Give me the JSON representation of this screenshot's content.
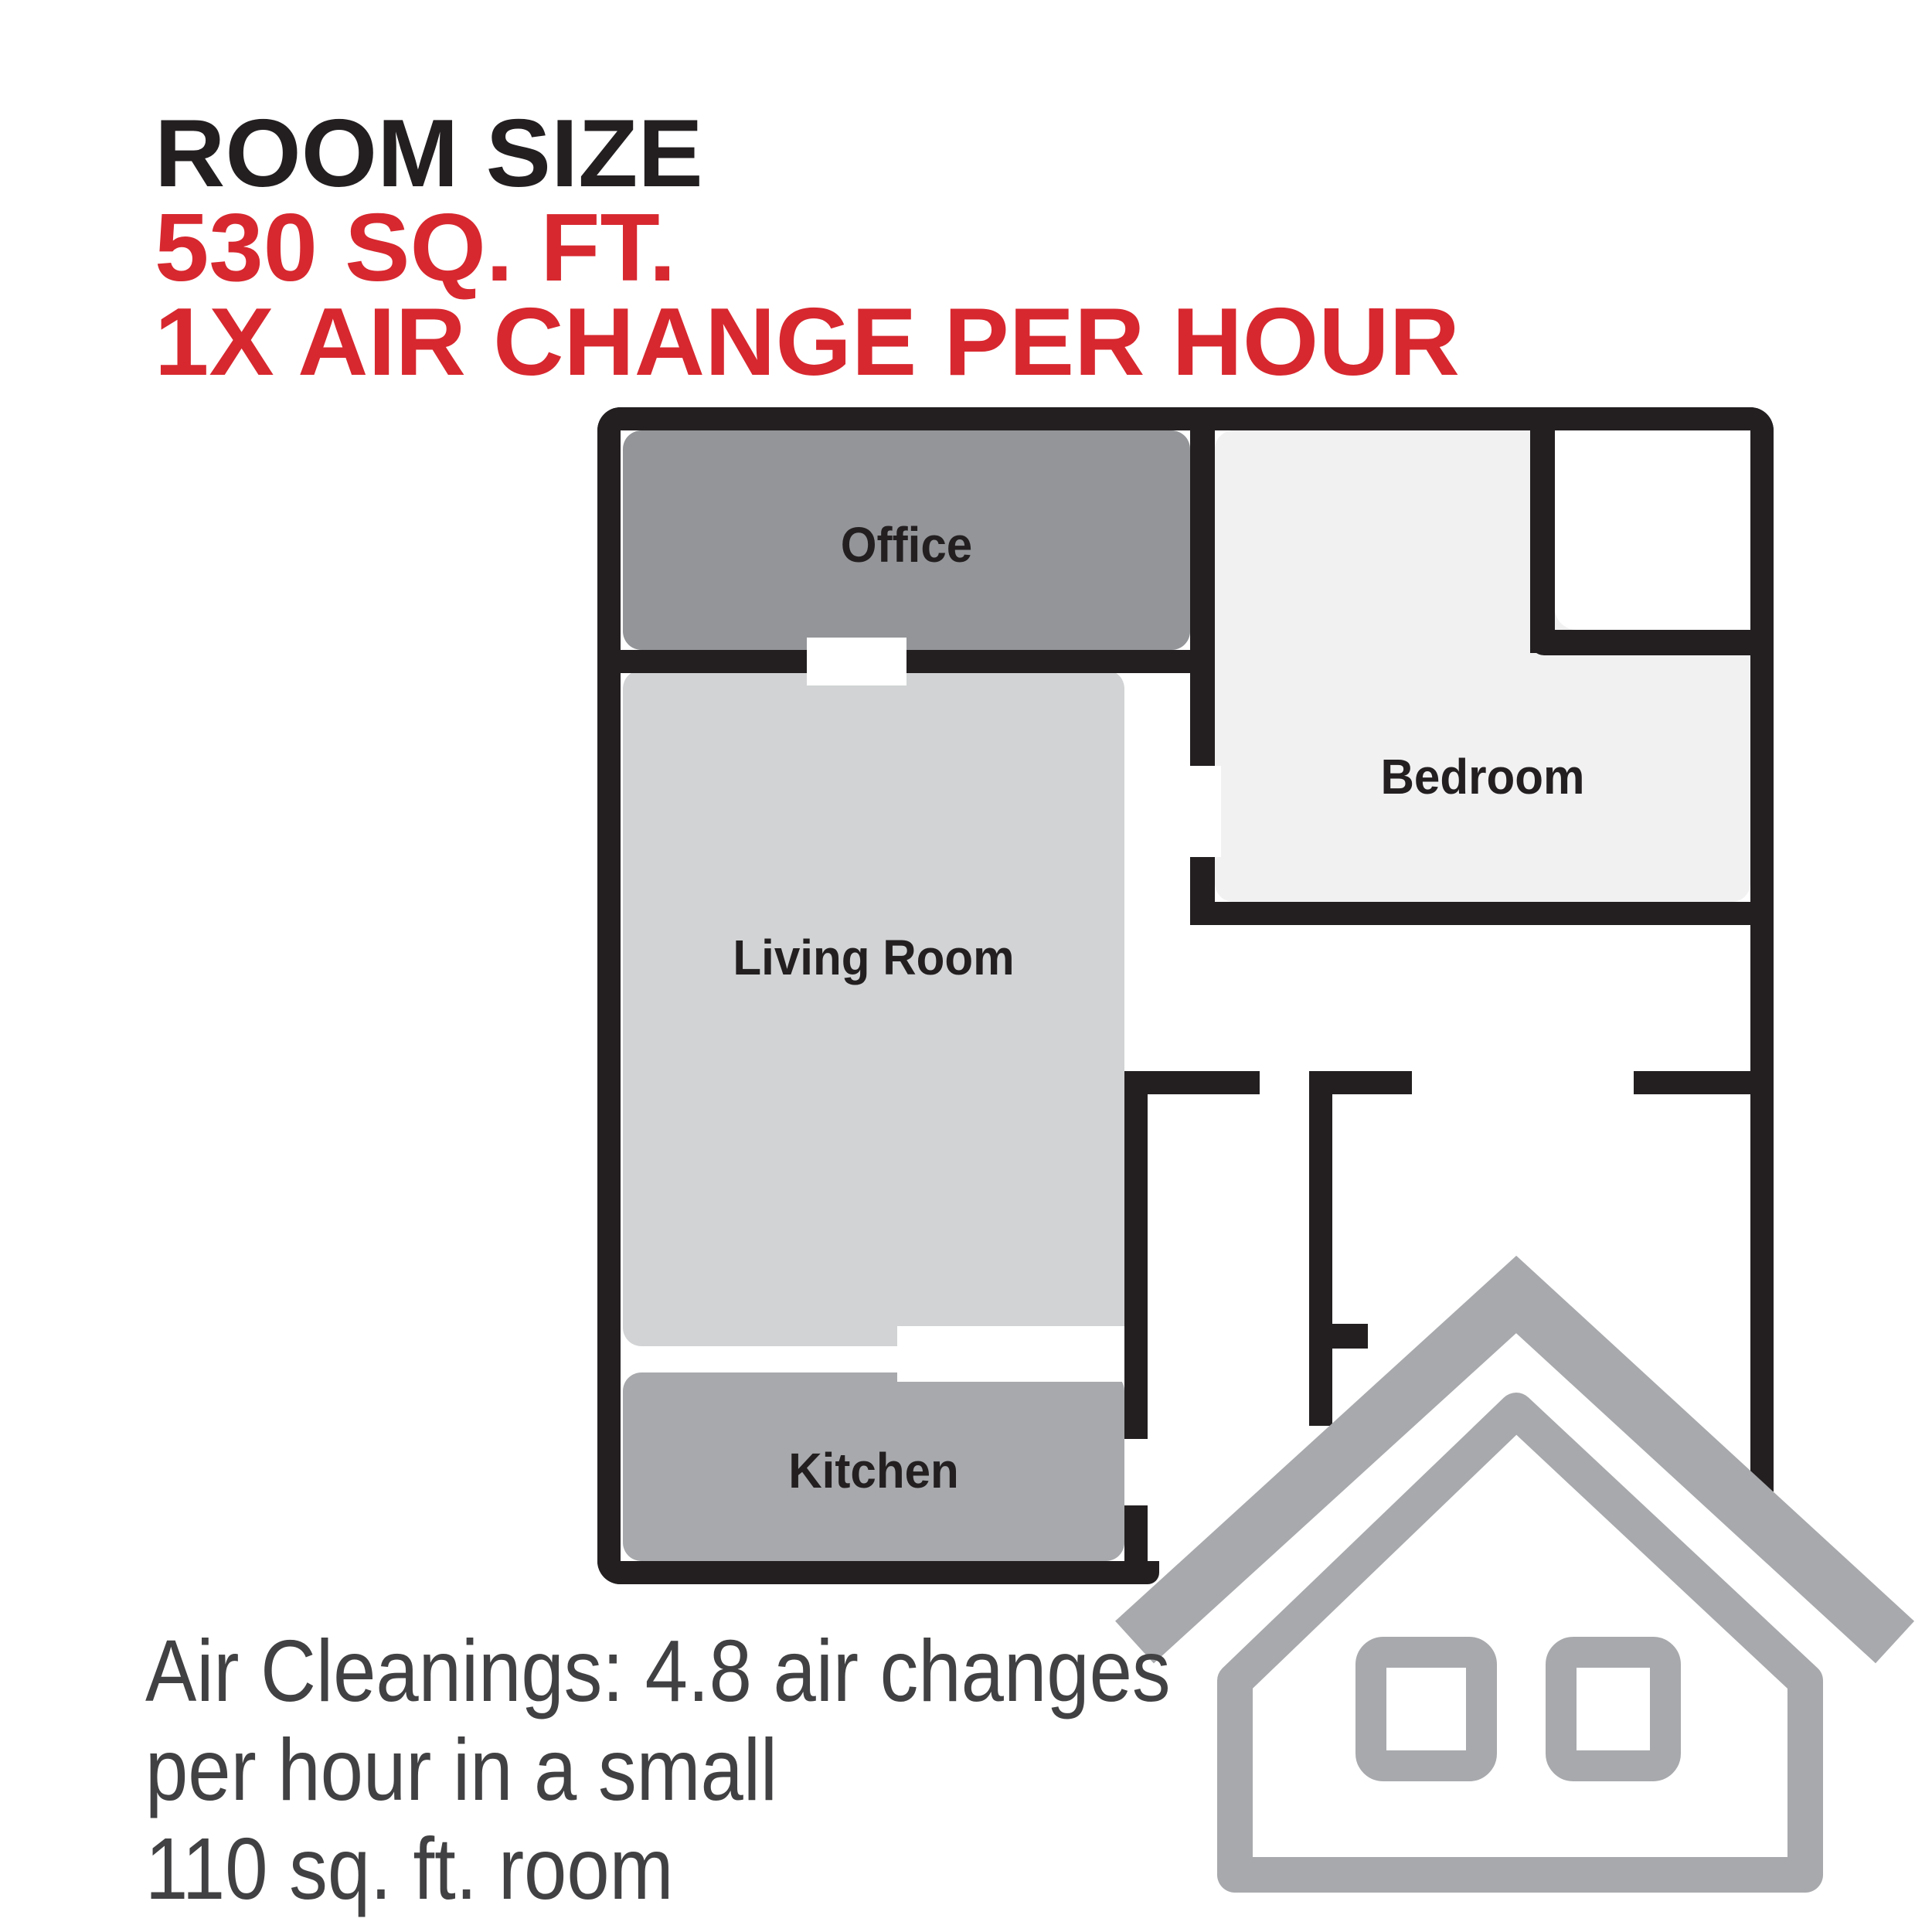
{
  "header": {
    "title": "ROOM SIZE",
    "subtitle_size": "530 SQ. FT.",
    "subtitle_rate": "1X AIR CHANGE PER HOUR"
  },
  "floorplan": {
    "rooms": [
      {
        "id": "office",
        "label": "Office"
      },
      {
        "id": "bedroom",
        "label": "Bedroom"
      },
      {
        "id": "living-room",
        "label": "Living Room"
      },
      {
        "id": "kitchen",
        "label": "Kitchen"
      }
    ]
  },
  "caption": {
    "line1": "Air Cleanings: 4.8 air changes",
    "line2": "per hour in a small",
    "line3": "110 sq. ft. room"
  },
  "icons": [
    {
      "name": "house-icon",
      "meaning": "small house / room icon"
    }
  ],
  "colors": {
    "accent_red": "#d7282f",
    "wall_black": "#231f20",
    "office_fill": "#939598",
    "living_fill": "#d1d3d4",
    "kitchen_fill": "#a7a9ac",
    "bedroom_fill": "#f1f1f2",
    "house_icon_gray": "#a7a9ac",
    "caption_text": "#414042",
    "background": "#ffffff"
  }
}
